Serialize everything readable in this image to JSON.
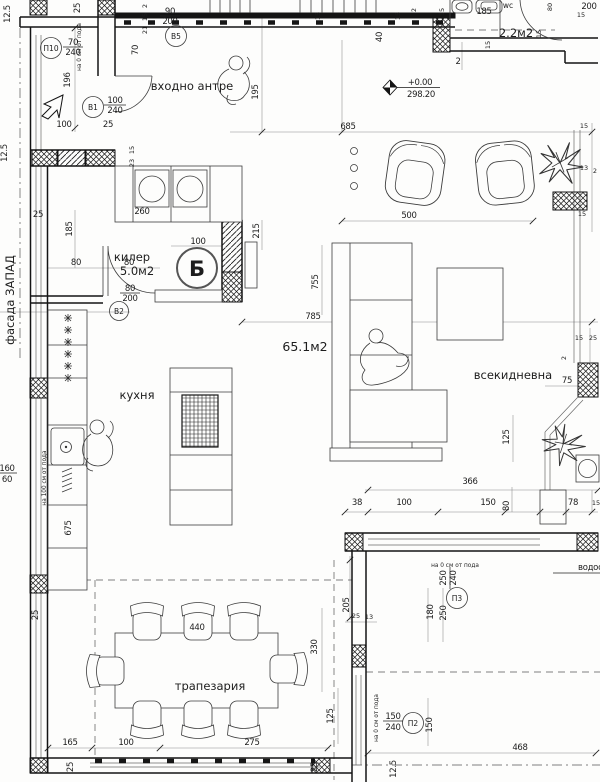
{
  "rooms": {
    "entry": {
      "label": "входно антре"
    },
    "pantry": {
      "label": "килер",
      "area": "5.0м2"
    },
    "kitchen": {
      "label": "кухня"
    },
    "dining": {
      "label": "трапезария"
    },
    "living": {
      "label": "всекидневна"
    },
    "main_area": {
      "area": "65.1м2"
    },
    "wc": {
      "label": "wc",
      "area": "2.2м2"
    }
  },
  "markers": {
    "p10": {
      "id": "П10",
      "num": "70",
      "den": "240"
    },
    "b5": {
      "id": "B5",
      "num": "90",
      "den": "200"
    },
    "b1": {
      "id": "B1",
      "num": "100",
      "den": "240"
    },
    "b2": {
      "id": "B2",
      "num": "80",
      "den": "200"
    },
    "section_b": {
      "id": "Б"
    },
    "p3": {
      "id": "П3",
      "num": "250",
      "den": "240"
    },
    "p2": {
      "id": "П2",
      "num": "150",
      "den": "240"
    }
  },
  "annotations": {
    "elevation_level": "+0.00",
    "elevation_absolute": "298.20",
    "facade_west": "фасада ЗАПАД",
    "floor_note_0": "на 0 см от пода",
    "floor_note_100": "на 100 см от пода",
    "drainpipe": "водосточна",
    "window_num": "160",
    "window_den": "60"
  },
  "dims": {
    "d0": "12.5",
    "d1": "25",
    "d2": "2",
    "d3": "15",
    "d4": "21",
    "d5": "70",
    "d6": "196",
    "d7": "100",
    "d8": "25",
    "d9": "195",
    "d10": "15",
    "d11": "15",
    "d12": "2",
    "d13": "40",
    "d14": "2",
    "d15": "685",
    "d16": "185",
    "d17": "80",
    "d18": "200",
    "d19": "15",
    "d20": "15",
    "d21": "15",
    "d22": "15",
    "d23": "500",
    "d24": "15",
    "d25": "13",
    "d26": "2",
    "d27": "15",
    "d28": "755",
    "d29": "785",
    "d30": "215",
    "d31": "100",
    "d32": "25",
    "d33": "260",
    "d34": "185",
    "d35": "80",
    "d36": "80",
    "d37": "675",
    "d38": "366",
    "d39": "38",
    "d40": "100",
    "d41": "150",
    "d42": "80",
    "d43": "78",
    "d44": "15",
    "d45": "75",
    "d46": "125",
    "d47": "15",
    "d48": "25",
    "d49": "2",
    "d50": "440",
    "d51": "330",
    "d52": "165",
    "d53": "100",
    "d54": "275",
    "d55": "25",
    "d56": "25",
    "d57": "25",
    "d58": "205",
    "d59": "25",
    "d60": "13",
    "d61": "125",
    "d62": "180",
    "d63": "150",
    "d64": "468",
    "d65": "12.5",
    "d66": "15",
    "d67": "23",
    "d68": "12.5",
    "d69": "250"
  }
}
